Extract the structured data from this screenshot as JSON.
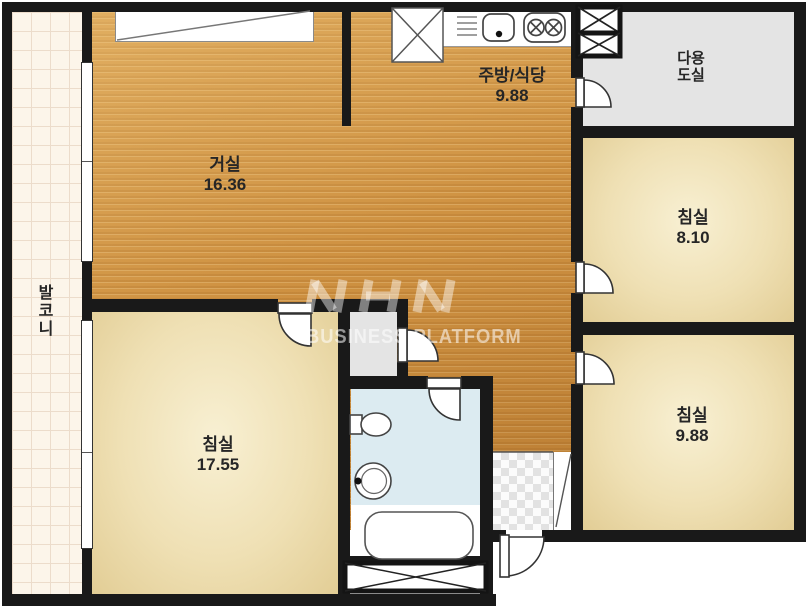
{
  "floorplan": {
    "balcony": {
      "name": "발코니"
    },
    "living": {
      "name": "거실",
      "area": "16.36"
    },
    "kitchen": {
      "name": "주방/식당",
      "area": "9.88"
    },
    "utility": {
      "name_line1": "다용",
      "name_line2": "도실"
    },
    "bedroom_right_top": {
      "name": "침실",
      "area": "8.10"
    },
    "bedroom_right_bottom": {
      "name": "침실",
      "area": "9.88"
    },
    "bedroom_left": {
      "name": "침실",
      "area": "17.55"
    }
  },
  "watermark": {
    "logo": "NHN",
    "text": "BUSINESS PLATFORM"
  },
  "colors": {
    "wall": "#191919",
    "wood_floor": "#cf9242",
    "bedroom_floor": "#efe0b4",
    "balcony_tile": "#fcf5ea",
    "utility_floor": "#e4e4e4",
    "bathroom_floor": "#dcebf1"
  }
}
